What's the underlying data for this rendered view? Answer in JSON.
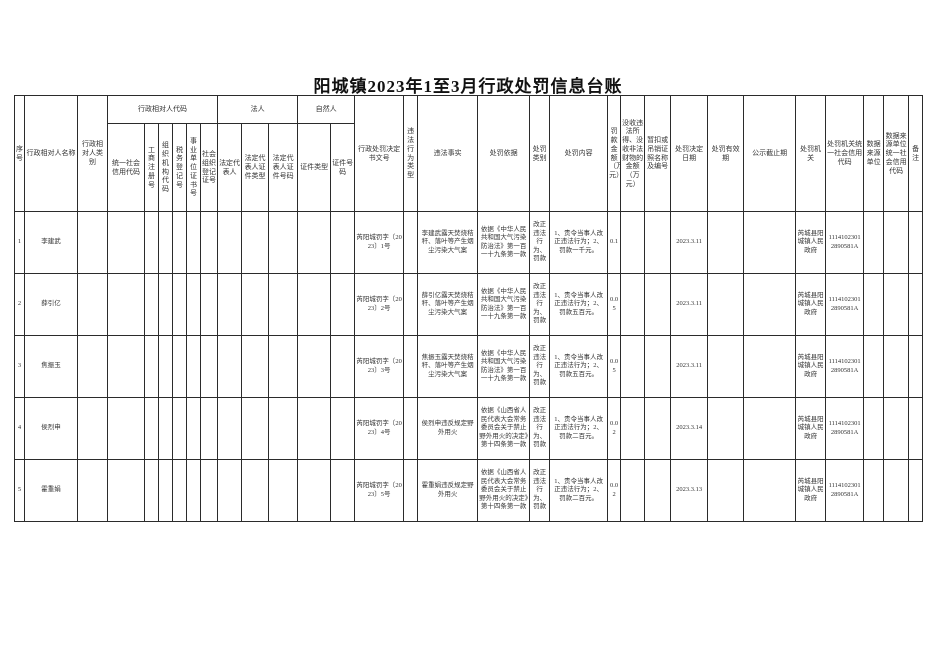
{
  "page": {
    "title": "阳城镇2023年1至3月行政处罚信息台账"
  },
  "table": {
    "header": {
      "seq": "序号",
      "name": "行政相对人名称",
      "category": "行政相对人类别",
      "code_group": "行政相对人代码",
      "legal_group": "法人",
      "natural_group": "自然人",
      "sub": [
        "统一社会信用代码",
        "工商注册号",
        "组织机构代码",
        "税务登记号",
        "事业单位证书号",
        "社会组织登记证号",
        "法定代表人",
        "法定代表人证件类型",
        "法定代表人证件号码",
        "证件类型",
        "证件号码"
      ],
      "rest": [
        "行政处罚决定书文号",
        "违法行为类型",
        "违法事实",
        "处罚依据",
        "处罚类别",
        "处罚内容",
        "罚款金额（万元）",
        "没收违法所得、没收非法财物的金额（万元）",
        "暂扣或吊销证照名称及编号",
        "处罚决定日期",
        "处罚有效期",
        "公示截止期",
        "处罚机关",
        "处罚机关统一社会信用代码",
        "数据来源单位",
        "数据来源单位统一社会信用代码",
        "备注"
      ]
    },
    "rows": [
      {
        "seq": "1",
        "name": "李建武",
        "doc_no": "芮阳城罚字〔2023〕1号",
        "fact": "李建武露天焚烧秸秆、落叶等产生烟尘污染大气案",
        "basis": "依据《中华人民共和国大气污染防治法》第一百一十九条第一款",
        "penalty_type": "改正违法行为、罚款",
        "content": "1、责令当事人改正违法行为；2、罚款一千元。",
        "fine": "0.1",
        "date": "2023.3.11",
        "organ": "芮城县阳城镇人民政府",
        "organ_code": "11141023012890581A"
      },
      {
        "seq": "2",
        "name": "薛引亿",
        "doc_no": "芮阳城罚字〔2023〕2号",
        "fact": "薛引亿露天焚烧秸秆、落叶等产生烟尘污染大气案",
        "basis": "依据《中华人民共和国大气污染防治法》第一百一十九条第一款",
        "penalty_type": "改正违法行为、罚款",
        "content": "1、责令当事人改正违法行为；2、罚款五百元。",
        "fine": "0.05",
        "date": "2023.3.11",
        "organ": "芮城县阳城镇人民政府",
        "organ_code": "11141023012890581A"
      },
      {
        "seq": "3",
        "name": "焦振玉",
        "doc_no": "芮阳城罚字〔2023〕3号",
        "fact": "焦振玉露天焚烧秸秆、落叶等产生烟尘污染大气案",
        "basis": "依据《中华人民共和国大气污染防治法》第一百一十九条第一款",
        "penalty_type": "改正违法行为、罚款",
        "content": "1、责令当事人改正违法行为；2、罚款五百元。",
        "fine": "0.05",
        "date": "2023.3.11",
        "organ": "芮城县阳城镇人民政府",
        "organ_code": "11141023012890581A"
      },
      {
        "seq": "4",
        "name": "侯烈申",
        "doc_no": "芮阳城罚字〔2023〕4号",
        "fact": "侯烈申违反规定野外用火",
        "basis": "依据《山西省人民代表大会常务委员会关于禁止野外用火的决定》第十四条第一款",
        "penalty_type": "改正违法行为、罚款",
        "content": "1、责令当事人改正违法行为；2、罚款二百元。",
        "fine": "0.02",
        "date": "2023.3.14",
        "organ": "芮城县阳城镇人民政府",
        "organ_code": "11141023012890581A"
      },
      {
        "seq": "5",
        "name": "霍重娟",
        "doc_no": "芮阳城罚字〔2023〕5号",
        "fact": "霍重娟违反规定野外用火",
        "basis": "依据《山西省人民代表大会常务委员会关于禁止野外用火的决定》第十四条第一款",
        "penalty_type": "改正违法行为、罚款",
        "content": "1、责令当事人改正违法行为；2、罚款二百元。",
        "fine": "0.02",
        "date": "2023.3.13",
        "organ": "芮城县阳城镇人民政府",
        "organ_code": "11141023012890581A"
      }
    ]
  }
}
